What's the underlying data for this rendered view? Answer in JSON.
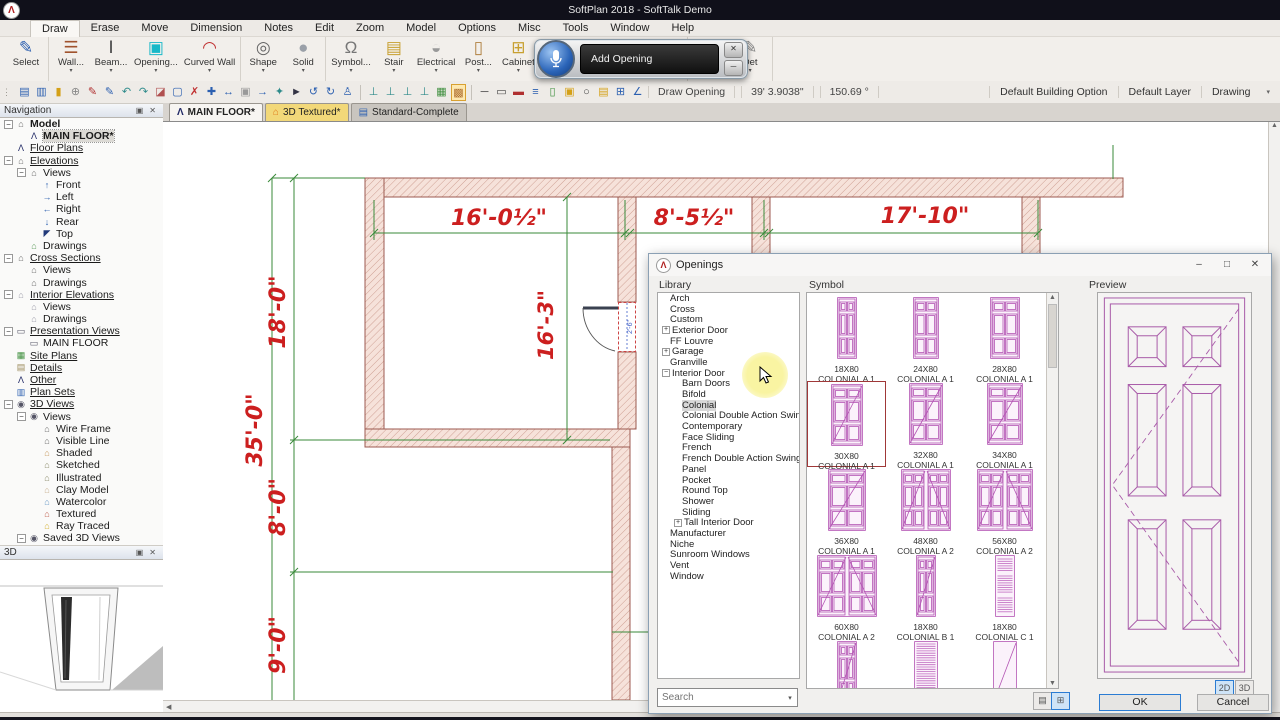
{
  "app": {
    "title": "SoftPlan 2018 - SoftTalk Demo"
  },
  "menu": {
    "active": "Draw",
    "tabs": [
      "Draw",
      "Erase",
      "Move",
      "Dimension",
      "Notes",
      "Edit",
      "Zoom",
      "Model",
      "Options",
      "Misc",
      "Tools",
      "Window",
      "Help"
    ]
  },
  "ribbon": {
    "groups": [
      [
        {
          "label": "Select",
          "icon": "select"
        }
      ],
      [
        {
          "label": "Wall...",
          "icon": "wall",
          "drop": 1
        },
        {
          "label": "Beam...",
          "icon": "beam",
          "drop": 1
        },
        {
          "label": "Opening...",
          "icon": "opening",
          "drop": 1
        },
        {
          "label": "Curved Wall",
          "icon": "curved-wall",
          "drop": 1
        }
      ],
      [
        {
          "label": "Shape",
          "icon": "shape",
          "drop": 1
        },
        {
          "label": "Solid",
          "icon": "solid",
          "drop": 1
        }
      ],
      [
        {
          "label": "Symbol...",
          "icon": "symbol",
          "drop": 1
        },
        {
          "label": "Stair",
          "icon": "stair",
          "drop": 1
        },
        {
          "label": "Electrical",
          "icon": "electrical",
          "drop": 1
        },
        {
          "label": "Post...",
          "icon": "post",
          "drop": 1
        },
        {
          "label": "Cabinet",
          "icon": "cabinet",
          "drop": 1
        },
        {
          "label": "Deck",
          "icon": "deck",
          "drop": 1
        },
        {
          "label": "Banding...",
          "icon": "banding",
          "drop": 1
        },
        {
          "label": "Rod and Shelf",
          "icon": "rodshelf"
        }
      ],
      [
        {
          "label": "Paint",
          "icon": "paint",
          "drop": 1
        },
        {
          "label": "Det",
          "icon": "det",
          "drop": 1
        }
      ]
    ]
  },
  "quickbar": [
    {
      "n": "save"
    },
    {
      "n": "save-all"
    },
    {
      "n": "lock"
    },
    {
      "n": "clamp"
    },
    {
      "n": "brush-red"
    },
    {
      "n": "pen-blue"
    },
    {
      "n": "undo"
    },
    {
      "n": "redo"
    },
    {
      "n": "eraser"
    },
    {
      "n": "region"
    },
    {
      "n": "delete"
    },
    {
      "n": "move"
    },
    {
      "n": "pan"
    },
    {
      "n": "image"
    },
    {
      "n": "arrow-right-blue"
    },
    {
      "n": "walk"
    },
    {
      "n": "pointer"
    },
    {
      "n": "rotate-ccw"
    },
    {
      "n": "rotate-cw"
    },
    {
      "n": "person"
    },
    {
      "sep": 1
    },
    {
      "n": "level-a"
    },
    {
      "n": "level-b"
    },
    {
      "n": "level-c"
    },
    {
      "n": "level-d"
    },
    {
      "n": "grid-green"
    },
    {
      "n": "grid-multi",
      "active": 1
    },
    {
      "sep": 1
    },
    {
      "n": "line"
    },
    {
      "n": "rect"
    },
    {
      "n": "wall-red"
    },
    {
      "n": "stack-blue"
    },
    {
      "n": "column-green"
    },
    {
      "n": "cabinet-gold"
    },
    {
      "n": "circle"
    },
    {
      "n": "banding-gold"
    },
    {
      "n": "grid-plus"
    },
    {
      "n": "angle"
    }
  ],
  "statusbar": {
    "mode": "Draw Opening",
    "length": "39' 3.9038\"",
    "angle": "150.69 °",
    "right": [
      "Default Building Option",
      "Default Layer",
      "Drawing"
    ]
  },
  "doc_tabs": [
    {
      "label": "MAIN FLOOR*",
      "icon": "logo",
      "active": 1
    },
    {
      "label": "3D Textured*",
      "icon": "dt-house",
      "hl": 1
    },
    {
      "label": "Standard-Complete",
      "icon": "dt-book"
    }
  ],
  "navigation": {
    "title": "Navigation",
    "items": [
      {
        "l": "Model",
        "d": 0,
        "i": "house",
        "x": "-",
        "b": 1
      },
      {
        "l": "MAIN FLOOR*",
        "d": 1,
        "i": "logo",
        "b": 1,
        "sel": 1
      },
      {
        "l": "Floor Plans",
        "d": 0,
        "i": "logo",
        "u": 1
      },
      {
        "l": "Elevations",
        "d": 0,
        "i": "house",
        "x": "-",
        "u": 1
      },
      {
        "l": "Views",
        "d": 1,
        "i": "house",
        "x": "-"
      },
      {
        "l": "Front",
        "d": 2,
        "i": "arrow-up"
      },
      {
        "l": "Left",
        "d": 2,
        "i": "arrow-right"
      },
      {
        "l": "Right",
        "d": 2,
        "i": "arrow-left"
      },
      {
        "l": "Rear",
        "d": 2,
        "i": "arrow-down"
      },
      {
        "l": "Top",
        "d": 2,
        "i": "corner"
      },
      {
        "l": "Drawings",
        "d": 1,
        "i": "house-green"
      },
      {
        "l": "Cross Sections",
        "d": 0,
        "i": "house",
        "x": "-",
        "u": 1
      },
      {
        "l": "Views",
        "d": 1,
        "i": "house"
      },
      {
        "l": "Drawings",
        "d": 1,
        "i": "house"
      },
      {
        "l": "Interior Elevations",
        "d": 0,
        "i": "house-lt",
        "x": "-",
        "u": 1
      },
      {
        "l": "Views",
        "d": 1,
        "i": "house-lt"
      },
      {
        "l": "Drawings",
        "d": 1,
        "i": "house-lt"
      },
      {
        "l": "Presentation Views",
        "d": 0,
        "i": "monitor",
        "x": "-",
        "u": 1
      },
      {
        "l": "MAIN FLOOR",
        "d": 1,
        "i": "monitor"
      },
      {
        "l": "Site Plans",
        "d": 0,
        "i": "site",
        "u": 1
      },
      {
        "l": "Details",
        "d": 0,
        "i": "details",
        "u": 1
      },
      {
        "l": "Other",
        "d": 0,
        "i": "logo",
        "u": 1
      },
      {
        "l": "Plan Sets",
        "d": 0,
        "i": "plansets",
        "u": 1
      },
      {
        "l": "3D Views",
        "d": 0,
        "i": "eye",
        "x": "-",
        "u": 1
      },
      {
        "l": "Views",
        "d": 1,
        "i": "eye",
        "x": "-"
      },
      {
        "l": "Wire Frame",
        "d": 2,
        "i": "house"
      },
      {
        "l": "Visible Line",
        "d": 2,
        "i": "house"
      },
      {
        "l": "Shaded",
        "d": 2,
        "i": "house-shaded"
      },
      {
        "l": "Sketched",
        "d": 2,
        "i": "house-sketch"
      },
      {
        "l": "Illustrated",
        "d": 2,
        "i": "house-sketch"
      },
      {
        "l": "Clay Model",
        "d": 2,
        "i": "house-clay"
      },
      {
        "l": "Watercolor",
        "d": 2,
        "i": "house-water"
      },
      {
        "l": "Textured",
        "d": 2,
        "i": "house-red"
      },
      {
        "l": "Ray Traced",
        "d": 2,
        "i": "house-gold"
      },
      {
        "l": "Saved 3D Views",
        "d": 1,
        "i": "eye",
        "x": "-"
      }
    ]
  },
  "panel_3d": {
    "title": "3D"
  },
  "plan": {
    "top1": "16'-0½\"",
    "top2": "8'-5½\"",
    "top3": "17'-10\"",
    "v18": "18'-0\"",
    "v35": "35'-0\"",
    "v8": "8'-0\"",
    "v9": "9'-0\"",
    "interior": "16'-3\"",
    "door": "2'-6\""
  },
  "overlay": {
    "label": "Add Opening"
  },
  "dialog": {
    "title": "Openings",
    "window_buttons": {
      "minimize": "–",
      "maximize": "□",
      "close": "✕"
    },
    "library": {
      "label": "Library",
      "items": [
        {
          "l": "Arch",
          "d": 0
        },
        {
          "l": "Cross",
          "d": 0
        },
        {
          "l": "Custom",
          "d": 0
        },
        {
          "l": "Exterior Door",
          "d": 0,
          "x": "+"
        },
        {
          "l": "FF Louvre",
          "d": 0
        },
        {
          "l": "Garage",
          "d": 0,
          "x": "+"
        },
        {
          "l": "Granville",
          "d": 0
        },
        {
          "l": "Interior Door",
          "d": 0,
          "x": "-"
        },
        {
          "l": "Barn Doors",
          "d": 1
        },
        {
          "l": "Bifold",
          "d": 1
        },
        {
          "l": "Colonial",
          "d": 1,
          "sel": 1
        },
        {
          "l": "Colonial Double Action Swing",
          "d": 1
        },
        {
          "l": "Contemporary",
          "d": 1
        },
        {
          "l": "Face Sliding",
          "d": 1
        },
        {
          "l": "French",
          "d": 1
        },
        {
          "l": "French Double Action Swing",
          "d": 1
        },
        {
          "l": "Panel",
          "d": 1
        },
        {
          "l": "Pocket",
          "d": 1
        },
        {
          "l": "Round Top",
          "d": 1
        },
        {
          "l": "Shower",
          "d": 1
        },
        {
          "l": "Sliding",
          "d": 1
        },
        {
          "l": "Tall Interior Door",
          "d": 1,
          "x": "+"
        },
        {
          "l": "Manufacturer",
          "d": 0
        },
        {
          "l": "Niche",
          "d": 0
        },
        {
          "l": "Sunroom Windows",
          "d": 0
        },
        {
          "l": "Vent",
          "d": 0
        },
        {
          "l": "Window",
          "d": 0
        }
      ]
    },
    "symbols": {
      "label": "Symbol",
      "items": [
        {
          "size": "18X80",
          "name": "COLONIAL A 1",
          "w": 20,
          "k": "s"
        },
        {
          "size": "24X80",
          "name": "COLONIAL A 1",
          "w": 26,
          "k": "s"
        },
        {
          "size": "28X80",
          "name": "COLONIAL A 1",
          "w": 30,
          "k": "s"
        },
        {
          "size": "30X80",
          "name": "COLONIAL A 1",
          "w": 32,
          "k": "sd",
          "sel": 1
        },
        {
          "size": "32X80",
          "name": "COLONIAL A 1",
          "w": 34,
          "k": "sd"
        },
        {
          "size": "34X80",
          "name": "COLONIAL A 1",
          "w": 36,
          "k": "sd"
        },
        {
          "size": "36X80",
          "name": "COLONIAL A 1",
          "w": 38,
          "k": "sd"
        },
        {
          "size": "48X80",
          "name": "COLONIAL A 2",
          "w": 50,
          "k": "dd"
        },
        {
          "size": "56X80",
          "name": "COLONIAL A 2",
          "w": 56,
          "k": "dd"
        },
        {
          "size": "60X80",
          "name": "COLONIAL A 2",
          "w": 60,
          "k": "dd"
        },
        {
          "size": "18X80",
          "name": "COLONIAL B 1",
          "w": 20,
          "k": "sd"
        },
        {
          "size": "18X80",
          "name": "COLONIAL C 1",
          "w": 20,
          "k": "lv"
        },
        {
          "size": "",
          "name": "",
          "w": 20,
          "k": "sd"
        },
        {
          "size": "",
          "name": "",
          "w": 24,
          "k": "lf"
        },
        {
          "size": "",
          "name": "",
          "w": 24,
          "k": "fl"
        }
      ]
    },
    "preview": {
      "label": "Preview"
    },
    "search": {
      "placeholder": "Search"
    },
    "buttons": {
      "ok": "OK",
      "cancel": "Cancel",
      "mode_2d": "2D",
      "mode_3d": "3D"
    }
  },
  "colors": {
    "accent_blue": "#2b7cd3",
    "dim_red": "#cc1f1f",
    "dim_green": "#3a8a3a",
    "wall_fill": "#f6e2da",
    "wall_edge": "#9c5a50",
    "symbol_magenta": "#b455b4",
    "tab_highlight": "#f2d879"
  },
  "icons": {
    "logo": {
      "g": "Λ",
      "c": "#222a66"
    },
    "house": {
      "g": "⌂",
      "c": "#6a6a6a"
    },
    "house-green": {
      "g": "⌂",
      "c": "#5a9a5a"
    },
    "house-lt": {
      "g": "⌂",
      "c": "#9a9aa8"
    },
    "house-shaded": {
      "g": "⌂",
      "c": "#c89a60"
    },
    "house-sketch": {
      "g": "⌂",
      "c": "#8a8a6a"
    },
    "house-clay": {
      "g": "⌂",
      "c": "#c8b090"
    },
    "house-water": {
      "g": "⌂",
      "c": "#6a9ac8"
    },
    "house-red": {
      "g": "⌂",
      "c": "#c06050"
    },
    "house-gold": {
      "g": "⌂",
      "c": "#d4b030"
    },
    "arrow-up": {
      "g": "↑",
      "c": "#2b5fb0"
    },
    "arrow-right": {
      "g": "→",
      "c": "#2b5fb0"
    },
    "arrow-left": {
      "g": "←",
      "c": "#2b5fb0"
    },
    "arrow-down": {
      "g": "↓",
      "c": "#2b5fb0"
    },
    "corner": {
      "g": "◤",
      "c": "#223a7a"
    },
    "monitor": {
      "g": "▭",
      "c": "#555566"
    },
    "site": {
      "g": "▦",
      "c": "#3f8f3f"
    },
    "details": {
      "g": "▤",
      "c": "#9a8a5a"
    },
    "plansets": {
      "g": "▥",
      "c": "#2b5fb0"
    },
    "eye": {
      "g": "◉",
      "c": "#555566"
    },
    "dt-house": {
      "g": "⌂",
      "c": "#e07818"
    },
    "dt-book": {
      "g": "▤",
      "c": "#2b5fb0"
    },
    "select": {
      "g": "✎",
      "c": "#2b5fb0"
    },
    "wall": {
      "g": "☰",
      "c": "#a0522d"
    },
    "beam": {
      "g": "Ⅰ",
      "c": "#444444"
    },
    "opening": {
      "g": "▣",
      "c": "#18b8c8"
    },
    "curved-wall": {
      "g": "◠",
      "c": "#c03030"
    },
    "shape": {
      "g": "◎",
      "c": "#666666"
    },
    "solid": {
      "g": "●",
      "c": "#9aa0a8"
    },
    "symbol": {
      "g": "Ω",
      "c": "#777777"
    },
    "stair": {
      "g": "▤",
      "c": "#c8a030"
    },
    "electrical": {
      "g": "◒",
      "c": "#999999"
    },
    "post": {
      "g": "▯",
      "c": "#b08040"
    },
    "cabinet": {
      "g": "⊞",
      "c": "#c8a030"
    },
    "deck": {
      "g": "▥",
      "c": "#3f8f3f"
    },
    "banding": {
      "g": "▬",
      "c": "#2e8b8b"
    },
    "rodshelf": {
      "g": "∏",
      "c": "#888888"
    },
    "paint": {
      "g": "✐",
      "c": "#2b5fb0"
    },
    "det": {
      "g": "✎",
      "c": "#888888"
    },
    "save": {
      "g": "▤",
      "c": "#2b5fb0"
    },
    "save-all": {
      "g": "▥",
      "c": "#2b5fb0"
    },
    "lock": {
      "g": "▮",
      "c": "#d4a017"
    },
    "clamp": {
      "g": "⊕",
      "c": "#888888"
    },
    "brush-red": {
      "g": "✎",
      "c": "#b03030"
    },
    "pen-blue": {
      "g": "✎",
      "c": "#2b5fb0"
    },
    "undo": {
      "g": "↶",
      "c": "#2e8b8b"
    },
    "redo": {
      "g": "↷",
      "c": "#2e8b8b"
    },
    "eraser": {
      "g": "◪",
      "c": "#b05050"
    },
    "region": {
      "g": "▢",
      "c": "#2b5fb0"
    },
    "delete": {
      "g": "✗",
      "c": "#c03030"
    },
    "move": {
      "g": "✚",
      "c": "#2b5fb0"
    },
    "pan": {
      "g": "↔",
      "c": "#2b5fb0"
    },
    "image": {
      "g": "▣",
      "c": "#999999"
    },
    "arrow-right-blue": {
      "g": "→",
      "c": "#2b5fb0"
    },
    "walk": {
      "g": "✦",
      "c": "#2e8b8b"
    },
    "pointer": {
      "g": "►",
      "c": "#333344"
    },
    "rotate-ccw": {
      "g": "↺",
      "c": "#2b5fb0"
    },
    "rotate-cw": {
      "g": "↻",
      "c": "#2b5fb0"
    },
    "person": {
      "g": "♙",
      "c": "#2b5fb0"
    },
    "level-a": {
      "g": "⊥",
      "c": "#2e8b8b"
    },
    "level-b": {
      "g": "⊥",
      "c": "#2e8b8b"
    },
    "level-c": {
      "g": "⊥",
      "c": "#2e8b8b"
    },
    "level-d": {
      "g": "⊥",
      "c": "#2e8b8b"
    },
    "grid-green": {
      "g": "▦",
      "c": "#3f8f3f"
    },
    "grid-multi": {
      "g": "▩",
      "c": "#b07030"
    },
    "line": {
      "g": "─",
      "c": "#444444"
    },
    "rect": {
      "g": "▭",
      "c": "#444444"
    },
    "wall-red": {
      "g": "▬",
      "c": "#b03030"
    },
    "stack-blue": {
      "g": "≡",
      "c": "#2b5fb0"
    },
    "column-green": {
      "g": "▯",
      "c": "#3f8f3f"
    },
    "cabinet-gold": {
      "g": "▣",
      "c": "#d4a017"
    },
    "circle": {
      "g": "○",
      "c": "#444444"
    },
    "banding-gold": {
      "g": "▤",
      "c": "#d4a017"
    },
    "grid-plus": {
      "g": "⊞",
      "c": "#2b5fb0"
    },
    "angle": {
      "g": "∠",
      "c": "#2b5fb0"
    }
  }
}
